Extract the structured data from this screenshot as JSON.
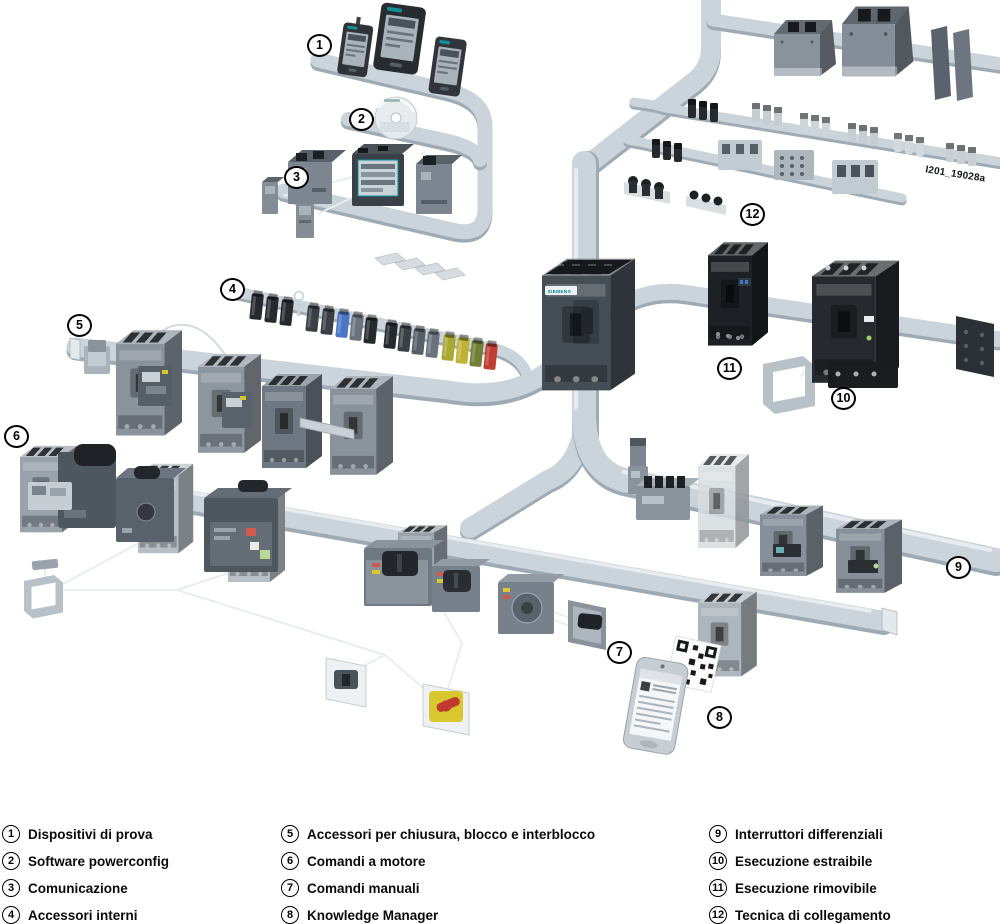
{
  "watermark": "I201_19028a",
  "center_breaker": {
    "brand_label": "SIEMENS"
  },
  "callouts": [
    "1",
    "2",
    "3",
    "4",
    "5",
    "6",
    "7",
    "8",
    "9",
    "10",
    "11",
    "12"
  ],
  "legend": {
    "items": [
      {
        "num": "1",
        "label": "Dispositivi di prova"
      },
      {
        "num": "2",
        "label": "Software powerconfig"
      },
      {
        "num": "3",
        "label": "Comunicazione"
      },
      {
        "num": "4",
        "label": "Accessori interni"
      },
      {
        "num": "5",
        "label": "Accessori per chiusura, blocco e interblocco"
      },
      {
        "num": "6",
        "label": "Comandi a motore"
      },
      {
        "num": "7",
        "label": "Comandi manuali"
      },
      {
        "num": "8",
        "label": "Knowledge Manager"
      },
      {
        "num": "9",
        "label": "Interruttori differenziali"
      },
      {
        "num": "10",
        "label": "Esecuzione estraibile"
      },
      {
        "num": "11",
        "label": "Esecuzione rimovibile"
      },
      {
        "num": "12",
        "label": "Tecnica di collegamento"
      }
    ]
  }
}
